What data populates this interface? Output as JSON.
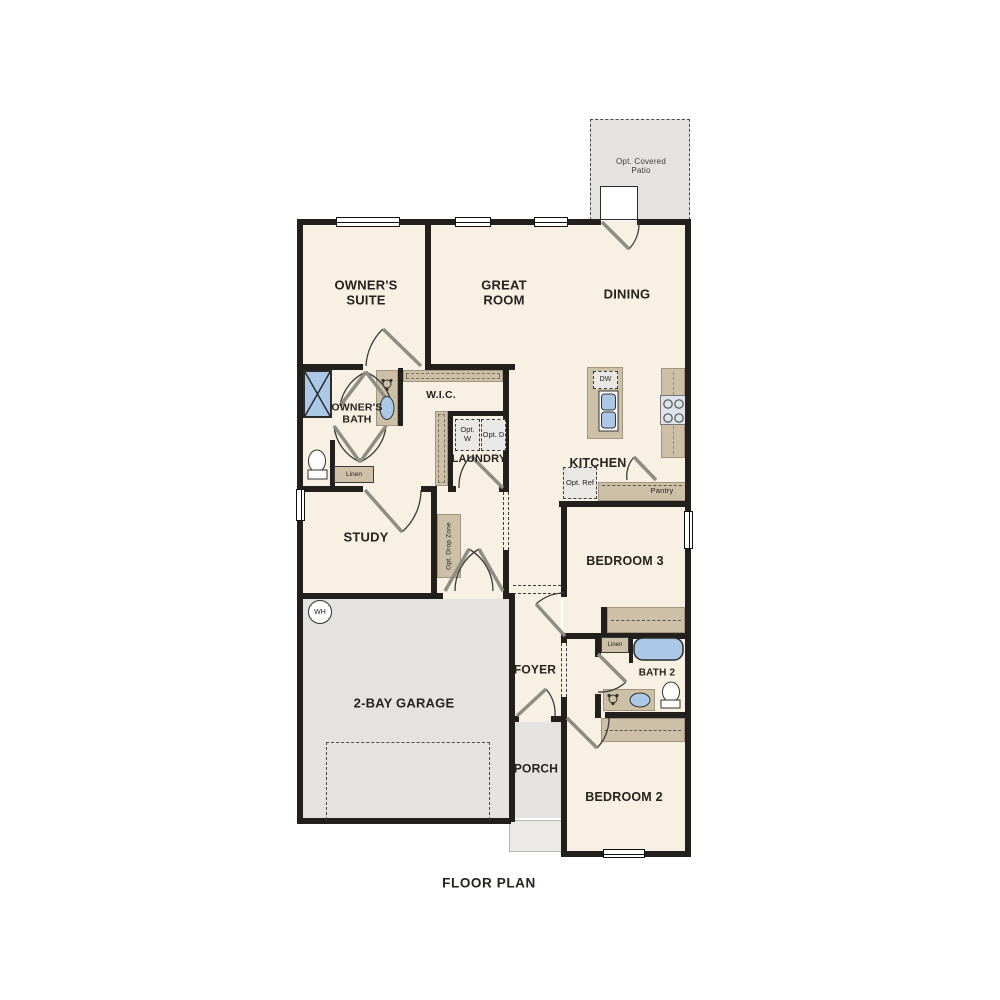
{
  "title": "FLOOR PLAN",
  "rooms": {
    "patio": "Opt. Covered Patio",
    "owners_suite": "OWNER'S SUITE",
    "great_room": "GREAT ROOM",
    "dining": "DINING",
    "owners_bath": "OWNER'S BATH",
    "wic": "W.I.C.",
    "laundry": "LAUNDRY",
    "kitchen": "KITCHEN",
    "study": "STUDY",
    "bedroom3": "BEDROOM 3",
    "foyer": "FOYER",
    "bath2": "BATH 2",
    "garage": "2-BAY GARAGE",
    "porch": "PORCH",
    "bedroom2": "BEDROOM 2"
  },
  "features": {
    "opt_washer": "Opt. W",
    "opt_dryer": "Opt. D",
    "opt_ref": "Opt. Ref",
    "dishwasher": "DW",
    "pantry": "Pantry",
    "linen_owners": "Linen",
    "linen_bath2": "Linen",
    "water_heater": "WH",
    "drop_zone": "Opt. Drop Zone"
  },
  "colors": {
    "floor": "#f8f0e2",
    "exterior_concrete": "#e4e3e1",
    "casework": "#cec0a6",
    "plumbing_fixture": "#abc9e7",
    "wall": "#231f1c"
  }
}
